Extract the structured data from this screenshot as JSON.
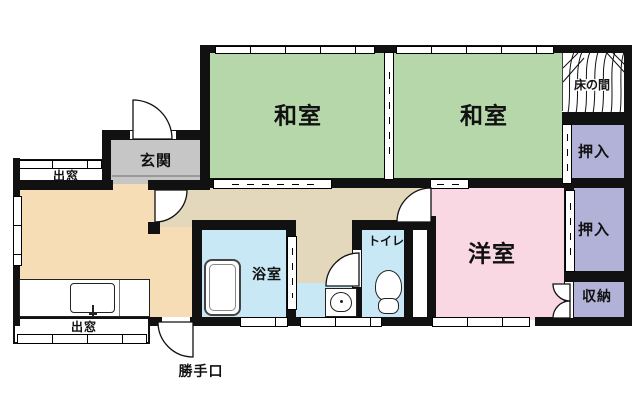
{
  "colors": {
    "tatami": "#b5d7aa",
    "western": "#fad8e3",
    "closet": "#b2b2d8",
    "wet": "#c8e8f6",
    "corridor": "#e3d7bc",
    "kitchen": "#f7ddb5",
    "genkan": "#c6c6c6",
    "tokonoma": "#ffffff",
    "wall": "#111111"
  },
  "rooms": {
    "washitsu1": {
      "label": "和室"
    },
    "washitsu2": {
      "label": "和室"
    },
    "yoshitsu": {
      "label": "洋室"
    },
    "genkan": {
      "label": "玄関"
    },
    "bathroom": {
      "label": "浴室"
    },
    "toilet": {
      "label": "トイレ"
    },
    "tokonoma": {
      "label": "床の間"
    },
    "oshiire_top": {
      "label": "押入"
    },
    "oshiire_mid": {
      "label": "押入"
    },
    "shuno": {
      "label": "収納"
    }
  },
  "features": {
    "demado_top": {
      "label": "出窓"
    },
    "demado_bottom": {
      "label": "出窓"
    },
    "katteguchi": {
      "label": "勝手口"
    }
  },
  "icons": {
    "bathtub": "bathtub-icon",
    "toilet_bowl": "toilet-icon",
    "kitchen_sink": "kitchen-sink-icon",
    "washbasin": "washbasin-icon",
    "wood_grain": "wood-grain-icon",
    "door_swing": "door-swing-arc",
    "window": "window-symbol",
    "sliding_door": "sliding-door-symbol"
  }
}
